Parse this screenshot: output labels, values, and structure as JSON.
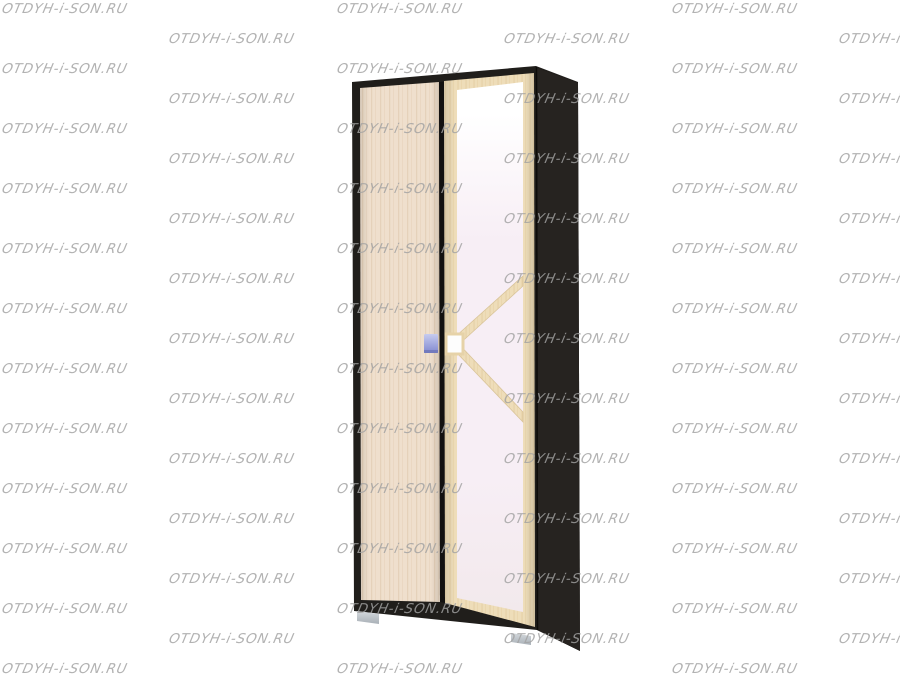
{
  "watermark": {
    "text": "OTDYH-i-SON.RU",
    "color": "#a2a2a2",
    "tile": {
      "start_x": 2,
      "start_y": 2,
      "row_spacing": 30,
      "col_spacing": 335,
      "odd_row_indent": 167,
      "columns": 3,
      "rows": 23
    }
  },
  "wardrobe": {
    "colors": {
      "background": "#ffffff",
      "frame_dark": "#201e1b",
      "side_dark": "#262320",
      "gap_dark": "#121110",
      "door_wood": "#efdfcd",
      "door_grain": "#e2ccb2",
      "mframe_wood": "#eeddb9",
      "mframe_grain": "#e0c897",
      "mirror_top": "#ffffff",
      "mirror_mid": "#f7eef5",
      "mirror_bot": "#f2e9ec",
      "handle_white": "#fdfdfd",
      "knob_light": "#c6cbef",
      "knob_dark": "#8289cf",
      "foot_light": "#d4d9dd",
      "foot_dark": "#a9b0b7"
    }
  }
}
